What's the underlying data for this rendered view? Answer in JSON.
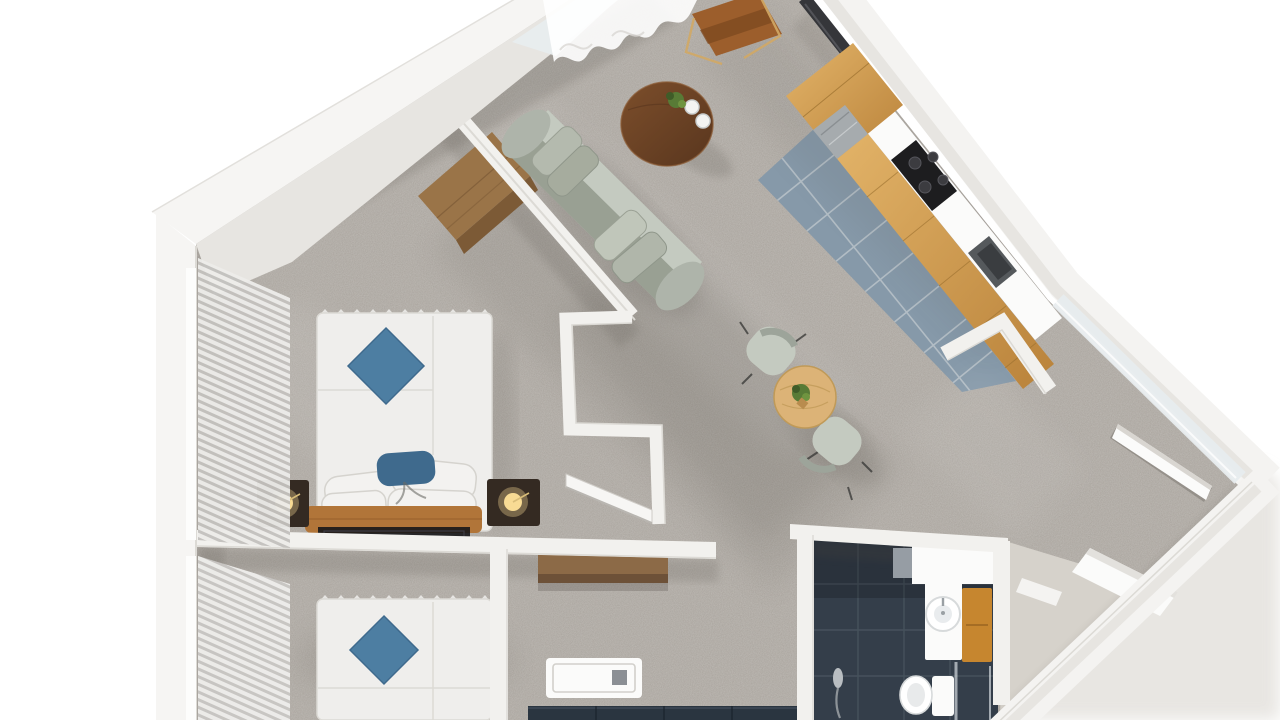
{
  "scene": {
    "title": "3D apartment floor plan render (top-down)",
    "view": "photoreal top-down 3D render, plan rotated ~40 degrees, white background",
    "palette": {
      "background": "#ffffff",
      "wall_top": "#f6f5f3",
      "wall_face": "#e7e5e1",
      "wall_edge": "#d8d5d0",
      "carpet": "#a9a39c",
      "carpet_dark": "#8d8780",
      "kitchen_tile": "#8fa2b2",
      "tile_grout": "#c7d0d6",
      "oak": "#d6a458",
      "oak_dark": "#b9853d",
      "walnut": "#6b4226",
      "desk_wood": "#9a7448",
      "desk_wood_side": "#7c5a36",
      "dining_wood": "#dcb377",
      "sideboard_wood": "#8c6a47",
      "sofa": "#b7bdb3",
      "sofa_dark": "#99a093",
      "sofa_light": "#c4cac0",
      "bed_white": "#efeeec",
      "pillow_blue": "#4d7ea2",
      "pillow_blue_dark": "#3f6a8d",
      "bench_leather": "#b17539",
      "nightstand": "#342a22",
      "lamp_glow": "#f8db94",
      "bath_tile": "#343e4a",
      "bath_grout": "#49545f",
      "bath_oak": "#c6862f",
      "navy_cabinet": "#2a3540",
      "entry_floor": "#d6d2cb",
      "stainless": "#a6abae",
      "tv_dark": "#35363a",
      "chair_leather": "#9c5e2c",
      "plant_green": "#587b36",
      "glass": "#e8edef",
      "rug_dark": "#17171a",
      "white_fixture": "#fbfbfa",
      "blind_light": "#ededeb",
      "shadow": "#4a443e"
    },
    "rooms": [
      {
        "name": "Living Room",
        "furniture": [
          "sofa",
          "coffee-table",
          "desk",
          "leather-desk-chair",
          "wall-tv",
          "sheer-curtain"
        ]
      },
      {
        "name": "Kitchen",
        "furniture": [
          "oak-cabinet-run",
          "tall-oak-cabinet",
          "fridge",
          "cooktop",
          "sink",
          "blue-tile-floor"
        ]
      },
      {
        "name": "Dining Area",
        "furniture": [
          "round-oak-table",
          "fabric-chair",
          "fabric-chair",
          "potted-plant"
        ]
      },
      {
        "name": "Bedroom 1",
        "furniture": [
          "double-bed",
          "blue-diamond-pillow",
          "white-pillows",
          "leather-bench",
          "dark-rug",
          "nightstand-with-lamp",
          "nightstand-with-lamp",
          "wall-tv",
          "window-blinds"
        ]
      },
      {
        "name": "Bedroom 2",
        "furniture": [
          "double-bed",
          "blue-diamond-pillow",
          "window-blinds"
        ]
      },
      {
        "name": "Hallway",
        "furniture": [
          "wall-sideboard",
          "open-interior-door"
        ]
      },
      {
        "name": "Utility Nook",
        "furniture": [
          "shower-tray",
          "navy-cabinet-run"
        ]
      },
      {
        "name": "Bathroom",
        "furniture": [
          "vanity-column-sink",
          "oak-bath-cabinet",
          "toilet",
          "hand-shower",
          "glass-partition",
          "dark-tile-floor",
          "white-shelf"
        ]
      },
      {
        "name": "Entry",
        "furniture": [
          "open-entry-door",
          "white-step-platform",
          "door-mat",
          "glazed-wall-band",
          "beige-floor"
        ]
      }
    ]
  }
}
